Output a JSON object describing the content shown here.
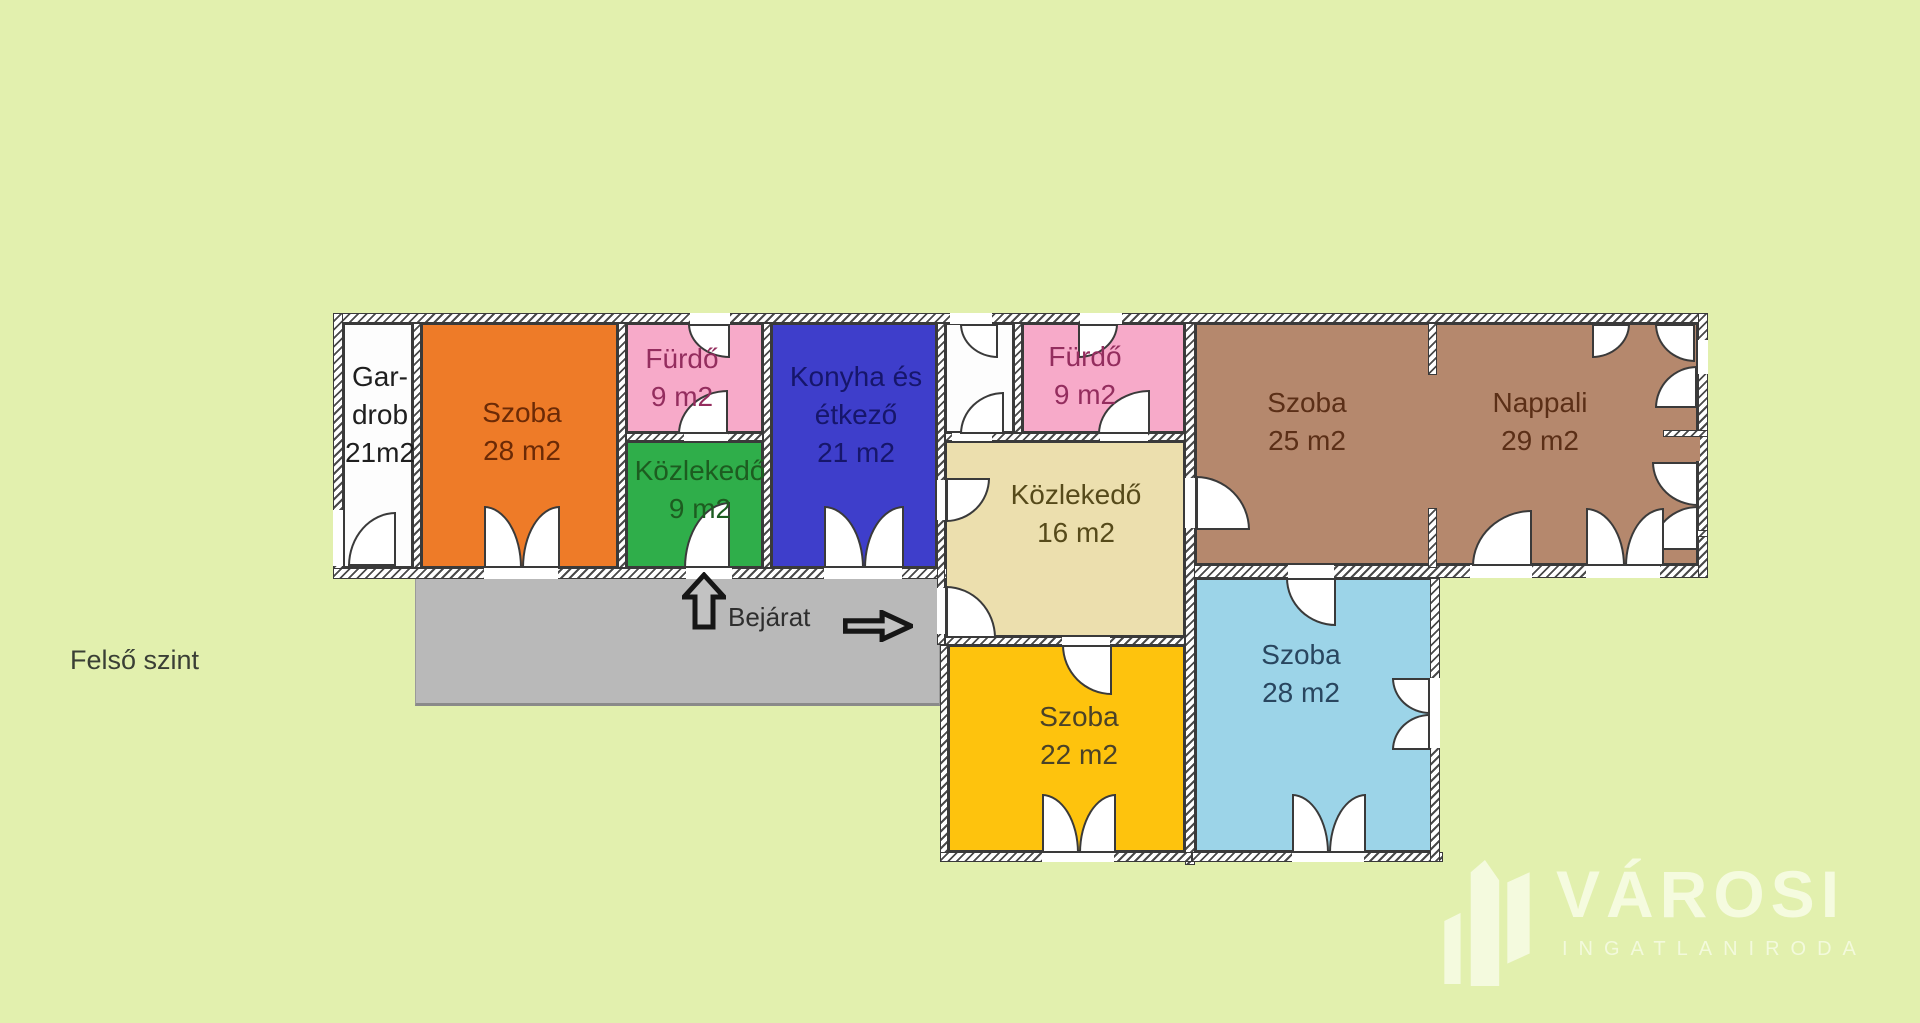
{
  "page": {
    "background": "#e2f0ae"
  },
  "floor_label": "Felső szint",
  "entrance": {
    "label": "Bejárat",
    "up_arrow_icon": "arrow-up-icon",
    "right_arrow_icon": "arrow-right-icon",
    "arrow_fill": "#c2c2c2",
    "arrow_outline": "#161616"
  },
  "logo": {
    "brand": "VÁROSI",
    "subtitle": "INGATLANIRODA",
    "color": "#f5fbe2",
    "icon": "buildings-icon"
  },
  "plan": {
    "wall_outline": "#3a3a3a",
    "terrace": {
      "id": "terrace",
      "color": "#b9b9b9",
      "rect": [
        415,
        578,
        525,
        128
      ]
    },
    "rooms": [
      {
        "id": "gardrob",
        "lines": [
          "Gar-",
          "drob",
          "",
          "21m2"
        ],
        "color": "#fdfdfd",
        "text_color": "#1f1f1f",
        "rect": [
          343,
          323,
          70,
          245
        ],
        "label": {
          "x": 380,
          "y": 358
        }
      },
      {
        "id": "szoba-28-a",
        "lines": [
          "Szoba",
          "28 m2"
        ],
        "color": "#ee7b28",
        "text_color": "#6b2a06",
        "rect": [
          421,
          323,
          197,
          245
        ],
        "label": {
          "x": 522,
          "y": 394
        }
      },
      {
        "id": "furdo-1",
        "lines": [
          "Fürdő",
          "9 m2"
        ],
        "color": "#f7aac9",
        "text_color": "#942d5e",
        "rect": [
          626,
          323,
          137,
          110
        ],
        "label": {
          "x": 682,
          "y": 340
        }
      },
      {
        "id": "kozlekedo-9",
        "lines": [
          "Közlekedő",
          "9 m2"
        ],
        "color": "#2fae4a",
        "text_color": "#1d5c20",
        "rect": [
          626,
          441,
          137,
          127
        ],
        "label": {
          "x": 700,
          "y": 452
        }
      },
      {
        "id": "konyha",
        "lines": [
          "Konyha és",
          "étkező",
          "21 m2"
        ],
        "color": "#3e3ecb",
        "text_color": "#16166b",
        "rect": [
          771,
          323,
          166,
          245
        ],
        "label": {
          "x": 856,
          "y": 358
        }
      },
      {
        "id": "corridor",
        "lines": [],
        "color": "#fdfdfd",
        "text_color": "#1f1f1f",
        "rect": [
          945,
          323,
          69,
          110
        ],
        "label": {
          "x": 979,
          "y": 350
        }
      },
      {
        "id": "furdo-2",
        "lines": [
          "Fürdő",
          "9 m2"
        ],
        "color": "#f7aac9",
        "text_color": "#942d5e",
        "rect": [
          1022,
          323,
          163,
          110
        ],
        "label": {
          "x": 1085,
          "y": 338
        }
      },
      {
        "id": "kozlekedo-16",
        "lines": [
          "Közlekedő",
          "16 m2"
        ],
        "color": "#ecdfae",
        "text_color": "#564a1a",
        "rect": [
          945,
          441,
          240,
          196
        ],
        "label": {
          "x": 1076,
          "y": 476
        }
      },
      {
        "id": "szoba-25",
        "lines": [
          "Szoba",
          "25 m2"
        ],
        "color": "#b5886d",
        "text_color": "#5b2f17",
        "rect": [
          1195,
          323,
          503,
          242
        ],
        "label": {
          "x": 1307,
          "y": 384
        }
      },
      {
        "id": "nappali",
        "lines": [
          "Nappali",
          "29 m2"
        ],
        "color": "#b5886d",
        "text_color": "#5b2f17",
        "rect": [
          1195,
          323,
          0,
          0
        ],
        "label": {
          "x": 1540,
          "y": 384
        }
      },
      {
        "id": "szoba-22",
        "lines": [
          "Szoba",
          "22 m2"
        ],
        "color": "#fec30d",
        "text_color": "#4a4228",
        "rect": [
          948,
          645,
          237,
          207
        ],
        "label": {
          "x": 1079,
          "y": 698
        }
      },
      {
        "id": "szoba-28-b",
        "lines": [
          "Szoba",
          "28 m2"
        ],
        "color": "#9cd4e8",
        "text_color": "#29465f",
        "rect": [
          1195,
          578,
          238,
          274
        ],
        "label": {
          "x": 1301,
          "y": 636
        }
      }
    ],
    "walls": [
      {
        "name": "outer-top",
        "rect": [
          333,
          313,
          1375,
          10
        ]
      },
      {
        "name": "outer-left",
        "rect": [
          333,
          313,
          10,
          265
        ]
      },
      {
        "name": "bottom-left-wing",
        "rect": [
          333,
          568,
          614,
          11
        ]
      },
      {
        "name": "bottom-right-wing",
        "rect": [
          1185,
          565,
          523,
          13
        ]
      },
      {
        "name": "outer-right",
        "rect": [
          1698,
          313,
          10,
          265
        ]
      },
      {
        "name": "gardrob-szoba",
        "rect": [
          413,
          323,
          8,
          245
        ]
      },
      {
        "name": "szoba-furdo",
        "rect": [
          618,
          323,
          8,
          245
        ]
      },
      {
        "name": "furdo-konyha",
        "rect": [
          763,
          323,
          8,
          245
        ]
      },
      {
        "name": "konyha-corridor",
        "rect": [
          937,
          323,
          8,
          322
        ]
      },
      {
        "name": "corridor-furdo2",
        "rect": [
          1014,
          323,
          8,
          110
        ]
      },
      {
        "name": "mid-vertical",
        "rect": [
          1185,
          323,
          10,
          542
        ]
      },
      {
        "name": "partition-stub-top",
        "rect": [
          1428,
          323,
          9,
          52
        ]
      },
      {
        "name": "partition-stub-bottom",
        "rect": [
          1428,
          508,
          9,
          60
        ]
      },
      {
        "name": "furdo1-bottom",
        "rect": [
          626,
          433,
          137,
          8
        ]
      },
      {
        "name": "furdo2-bottom",
        "rect": [
          945,
          433,
          240,
          8
        ]
      },
      {
        "name": "kozlekedo16-bottom",
        "rect": [
          945,
          637,
          240,
          8
        ]
      },
      {
        "name": "szoba22-left",
        "rect": [
          940,
          645,
          8,
          217
        ]
      },
      {
        "name": "szoba22-bottom",
        "rect": [
          940,
          852,
          252,
          10
        ]
      },
      {
        "name": "szoba28b-bottom",
        "rect": [
          1192,
          852,
          251,
          10
        ]
      },
      {
        "name": "szoba28b-right",
        "rect": [
          1430,
          578,
          10,
          284
        ]
      },
      {
        "name": "nappali-shelf-top",
        "rect": [
          1663,
          430,
          45,
          7
        ]
      },
      {
        "name": "nappali-shelf-bottom",
        "rect": [
          1663,
          530,
          45,
          7
        ]
      }
    ],
    "patches": [
      {
        "name": "nappali-tongue",
        "rect": [
          1660,
          437,
          40,
          24
        ],
        "color": "#b5886d"
      }
    ],
    "gaps": [
      [
        690,
        313,
        40,
        11
      ],
      [
        950,
        313,
        42,
        11
      ],
      [
        1080,
        313,
        42,
        11
      ],
      [
        333,
        510,
        10,
        56
      ],
      [
        484,
        568,
        74,
        11
      ],
      [
        686,
        568,
        46,
        11
      ],
      [
        824,
        568,
        78,
        11
      ],
      [
        684,
        433,
        44,
        8
      ],
      [
        1100,
        433,
        48,
        8
      ],
      [
        952,
        433,
        40,
        8
      ],
      [
        937,
        480,
        8,
        40
      ],
      [
        937,
        588,
        8,
        46
      ],
      [
        1185,
        478,
        10,
        50
      ],
      [
        1062,
        637,
        48,
        8
      ],
      [
        1288,
        565,
        46,
        13
      ],
      [
        1470,
        565,
        62,
        13
      ],
      [
        1586,
        565,
        74,
        13
      ],
      [
        1430,
        678,
        10,
        70
      ],
      [
        1042,
        852,
        72,
        10
      ],
      [
        1292,
        852,
        72,
        10
      ],
      [
        1698,
        340,
        10,
        34
      ]
    ],
    "arcs": [
      {
        "rect": [
          348,
          512,
          48,
          54
        ],
        "corner": "tl"
      },
      {
        "rect": [
          484,
          506,
          38,
          62
        ],
        "corner": "tr"
      },
      {
        "rect": [
          522,
          506,
          38,
          62
        ],
        "corner": "tl"
      },
      {
        "rect": [
          688,
          324,
          42,
          34
        ],
        "corner": "bl"
      },
      {
        "rect": [
          678,
          390,
          50,
          44
        ],
        "corner": "tl"
      },
      {
        "rect": [
          684,
          502,
          46,
          66
        ],
        "corner": "tl"
      },
      {
        "rect": [
          824,
          506,
          40,
          62
        ],
        "corner": "tr"
      },
      {
        "rect": [
          864,
          506,
          40,
          62
        ],
        "corner": "tl"
      },
      {
        "rect": [
          960,
          324,
          38,
          34
        ],
        "corner": "bl"
      },
      {
        "rect": [
          960,
          392,
          44,
          42
        ],
        "corner": "tl"
      },
      {
        "rect": [
          1078,
          324,
          40,
          34
        ],
        "corner": "br"
      },
      {
        "rect": [
          1098,
          390,
          52,
          44
        ],
        "corner": "tl"
      },
      {
        "rect": [
          946,
          478,
          44,
          44
        ],
        "corner": "br"
      },
      {
        "rect": [
          946,
          586,
          50,
          52
        ],
        "corner": "tr"
      },
      {
        "rect": [
          1196,
          476,
          54,
          54
        ],
        "corner": "tr"
      },
      {
        "rect": [
          1062,
          645,
          50,
          50
        ],
        "corner": "bl"
      },
      {
        "rect": [
          1286,
          578,
          50,
          48
        ],
        "corner": "bl"
      },
      {
        "rect": [
          1392,
          678,
          38,
          36
        ],
        "corner": "bl"
      },
      {
        "rect": [
          1392,
          714,
          38,
          36
        ],
        "corner": "tl"
      },
      {
        "rect": [
          1042,
          794,
          37,
          59
        ],
        "corner": "tr"
      },
      {
        "rect": [
          1079,
          794,
          37,
          59
        ],
        "corner": "tl"
      },
      {
        "rect": [
          1292,
          794,
          37,
          59
        ],
        "corner": "tr"
      },
      {
        "rect": [
          1329,
          794,
          37,
          59
        ],
        "corner": "tl"
      },
      {
        "rect": [
          1592,
          324,
          38,
          34
        ],
        "corner": "br"
      },
      {
        "rect": [
          1655,
          324,
          40,
          38
        ],
        "corner": "bl"
      },
      {
        "rect": [
          1655,
          366,
          42,
          42
        ],
        "corner": "tl"
      },
      {
        "rect": [
          1652,
          462,
          46,
          44
        ],
        "corner": "bl"
      },
      {
        "rect": [
          1652,
          506,
          46,
          44
        ],
        "corner": "tl"
      },
      {
        "rect": [
          1472,
          510,
          60,
          56
        ],
        "corner": "tl"
      },
      {
        "rect": [
          1586,
          508,
          39,
          58
        ],
        "corner": "tr"
      },
      {
        "rect": [
          1625,
          508,
          39,
          58
        ],
        "corner": "tl"
      }
    ]
  }
}
